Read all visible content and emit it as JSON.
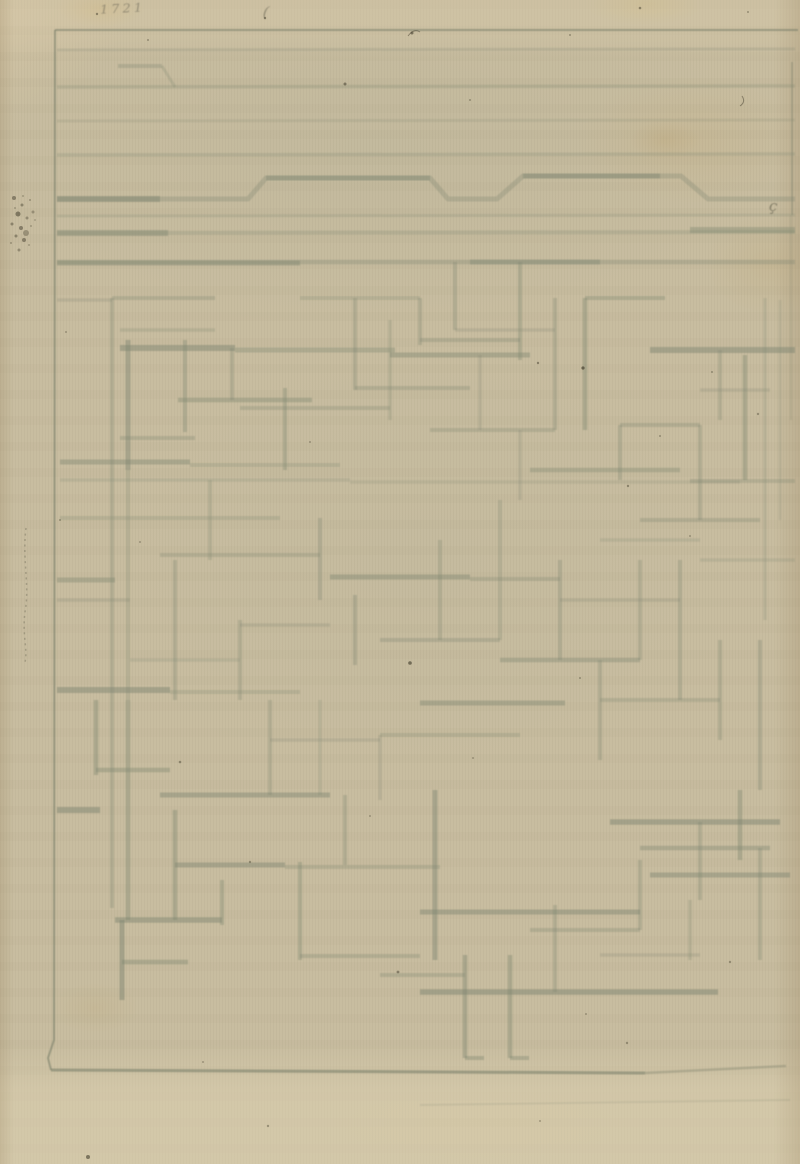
{
  "page": {
    "width": 800,
    "height": 1164
  },
  "colors": {
    "paper": "#c8bda0",
    "ink": "#7f8671",
    "frame_ink": "#6e7561",
    "speck": "#45402f",
    "inscription_ink": "#5f5c4a"
  },
  "inscriptions": {
    "corner_number": "1721",
    "paren_mark": "(",
    "cedilla_mark": "ç"
  },
  "drawing": {
    "frame": {
      "top": [
        55,
        30,
        798,
        30,
        2,
        0.5
      ],
      "left_points": "55,30 54,1040 48,1058 51,1070",
      "left_style": [
        2,
        0.5
      ],
      "bottom": [
        [
          51,
          1070,
          645,
          1073,
          3,
          0.5
        ],
        [
          645,
          1073,
          786,
          1066,
          2.5,
          0.3
        ],
        [
          420,
          1105,
          790,
          1100,
          2,
          0.12
        ]
      ],
      "right": [
        [
          792,
          62,
          792,
          215,
          2,
          0.3
        ],
        [
          791,
          215,
          791,
          420,
          2,
          0.15
        ]
      ]
    },
    "top_bands": [
      [
        57,
        50,
        795,
        49,
        3,
        0.22
      ],
      [
        57,
        87,
        795,
        86,
        3.5,
        0.26
      ],
      [
        57,
        121,
        795,
        120,
        3,
        0.18
      ],
      [
        57,
        155,
        795,
        154,
        3.5,
        0.24
      ],
      [
        57,
        216,
        795,
        215,
        3,
        0.2
      ],
      [
        57,
        233,
        795,
        232,
        4,
        0.26
      ],
      [
        57,
        233,
        168,
        233,
        6,
        0.42
      ],
      [
        690,
        230,
        795,
        230,
        6,
        0.4
      ],
      [
        57,
        262,
        795,
        262,
        4.5,
        0.3
      ],
      [
        57,
        263,
        300,
        263,
        5,
        0.42
      ],
      [
        470,
        262,
        600,
        262,
        5,
        0.38
      ],
      [
        57,
        199,
        160,
        199,
        6,
        0.45
      ],
      [
        266,
        178,
        430,
        178,
        5,
        0.35
      ],
      [
        523,
        176,
        660,
        176,
        5,
        0.4
      ],
      [
        118,
        66,
        162,
        66,
        4,
        0.3
      ],
      [
        162,
        66,
        175,
        87,
        3,
        0.25
      ]
    ],
    "band_bump_points": "57,199 248,199 266,178 430,178 448,199 497,199 523,176 681,176 708,199 795,199",
    "band_bump_style": [
      5,
      0.3
    ],
    "maze_segments": [
      [
        112,
        298,
        112,
        908,
        4,
        0.3
      ],
      [
        128,
        340,
        128,
        470,
        5,
        0.45
      ],
      [
        128,
        470,
        128,
        700,
        4,
        0.25
      ],
      [
        128,
        700,
        128,
        920,
        4.5,
        0.4
      ],
      [
        112,
        298,
        215,
        298,
        4,
        0.3
      ],
      [
        57,
        300,
        112,
        300,
        3.5,
        0.22
      ],
      [
        120,
        330,
        215,
        330,
        3.5,
        0.25
      ],
      [
        120,
        348,
        235,
        348,
        6,
        0.5
      ],
      [
        235,
        350,
        395,
        350,
        5,
        0.35
      ],
      [
        185,
        340,
        185,
        432,
        4,
        0.35
      ],
      [
        178,
        400,
        312,
        400,
        4.5,
        0.4
      ],
      [
        232,
        348,
        232,
        400,
        4,
        0.3
      ],
      [
        120,
        438,
        195,
        438,
        4,
        0.3
      ],
      [
        285,
        388,
        285,
        470,
        4,
        0.35
      ],
      [
        240,
        408,
        390,
        408,
        4,
        0.28
      ],
      [
        60,
        462,
        190,
        462,
        5,
        0.42
      ],
      [
        190,
        465,
        340,
        465,
        4,
        0.25
      ],
      [
        355,
        298,
        355,
        390,
        4,
        0.3
      ],
      [
        300,
        298,
        420,
        298,
        4,
        0.25
      ],
      [
        390,
        320,
        390,
        420,
        3.5,
        0.25
      ],
      [
        355,
        388,
        470,
        388,
        4,
        0.3
      ],
      [
        420,
        298,
        420,
        345,
        4,
        0.3
      ],
      [
        455,
        262,
        455,
        330,
        4,
        0.3
      ],
      [
        520,
        262,
        520,
        360,
        4,
        0.35
      ],
      [
        555,
        298,
        555,
        430,
        4,
        0.3
      ],
      [
        420,
        340,
        520,
        340,
        4,
        0.3
      ],
      [
        390,
        355,
        530,
        355,
        5,
        0.42
      ],
      [
        585,
        298,
        585,
        430,
        4.5,
        0.4
      ],
      [
        585,
        298,
        665,
        298,
        4,
        0.35
      ],
      [
        650,
        350,
        795,
        350,
        6,
        0.5
      ],
      [
        745,
        355,
        745,
        480,
        4.5,
        0.4
      ],
      [
        765,
        298,
        765,
        620,
        3.5,
        0.2
      ],
      [
        620,
        425,
        700,
        425,
        4,
        0.3
      ],
      [
        620,
        425,
        620,
        480,
        4,
        0.3
      ],
      [
        530,
        470,
        680,
        470,
        4.5,
        0.35
      ],
      [
        700,
        425,
        700,
        520,
        4,
        0.3
      ],
      [
        640,
        520,
        760,
        520,
        4,
        0.3
      ],
      [
        455,
        330,
        555,
        330,
        3.5,
        0.22
      ],
      [
        480,
        355,
        480,
        430,
        3.5,
        0.22
      ],
      [
        430,
        430,
        555,
        430,
        4,
        0.28
      ],
      [
        520,
        430,
        520,
        500,
        3.5,
        0.22
      ],
      [
        720,
        350,
        720,
        420,
        4,
        0.28
      ],
      [
        700,
        390,
        770,
        390,
        3.5,
        0.22
      ],
      [
        690,
        481,
        795,
        481,
        4,
        0.28
      ],
      [
        780,
        300,
        780,
        520,
        3,
        0.15
      ],
      [
        60,
        480,
        350,
        480,
        3.5,
        0.2
      ],
      [
        350,
        482,
        740,
        482,
        3.5,
        0.18
      ],
      [
        60,
        518,
        280,
        518,
        4,
        0.25
      ],
      [
        210,
        480,
        210,
        560,
        4,
        0.25
      ],
      [
        160,
        555,
        320,
        555,
        4,
        0.28
      ],
      [
        320,
        518,
        320,
        600,
        4,
        0.3
      ],
      [
        330,
        577,
        470,
        577,
        5,
        0.42
      ],
      [
        470,
        579,
        560,
        579,
        4,
        0.28
      ],
      [
        355,
        595,
        355,
        665,
        4,
        0.33
      ],
      [
        440,
        540,
        440,
        640,
        4,
        0.28
      ],
      [
        380,
        640,
        500,
        640,
        4,
        0.3
      ],
      [
        500,
        500,
        500,
        640,
        4,
        0.25
      ],
      [
        500,
        660,
        640,
        660,
        4.5,
        0.38
      ],
      [
        560,
        560,
        560,
        660,
        4,
        0.3
      ],
      [
        560,
        600,
        680,
        600,
        3.5,
        0.22
      ],
      [
        640,
        560,
        640,
        660,
        4,
        0.28
      ],
      [
        680,
        560,
        680,
        700,
        4,
        0.3
      ],
      [
        700,
        560,
        795,
        560,
        3.5,
        0.2
      ],
      [
        600,
        540,
        700,
        540,
        3.5,
        0.2
      ],
      [
        57,
        580,
        115,
        580,
        5,
        0.4
      ],
      [
        57,
        600,
        130,
        600,
        3.5,
        0.22
      ],
      [
        175,
        560,
        175,
        700,
        4,
        0.3
      ],
      [
        57,
        690,
        170,
        690,
        6,
        0.5
      ],
      [
        170,
        692,
        300,
        692,
        4,
        0.25
      ],
      [
        240,
        620,
        240,
        700,
        4,
        0.28
      ],
      [
        240,
        625,
        330,
        625,
        3.5,
        0.22
      ],
      [
        130,
        660,
        240,
        660,
        3.5,
        0.2
      ],
      [
        420,
        703,
        565,
        703,
        5,
        0.42
      ],
      [
        600,
        660,
        600,
        760,
        4,
        0.3
      ],
      [
        600,
        700,
        720,
        700,
        4,
        0.28
      ],
      [
        720,
        640,
        720,
        740,
        4,
        0.3
      ],
      [
        760,
        640,
        760,
        790,
        4,
        0.33
      ],
      [
        96,
        700,
        96,
        775,
        4.5,
        0.4
      ],
      [
        96,
        770,
        170,
        770,
        4.5,
        0.4
      ],
      [
        57,
        810,
        100,
        810,
        6,
        0.5
      ],
      [
        160,
        795,
        330,
        795,
        5,
        0.45
      ],
      [
        175,
        810,
        175,
        920,
        4.5,
        0.4
      ],
      [
        175,
        865,
        285,
        865,
        5,
        0.45
      ],
      [
        285,
        867,
        440,
        867,
        4,
        0.28
      ],
      [
        222,
        880,
        222,
        925,
        4,
        0.35
      ],
      [
        115,
        920,
        222,
        920,
        5.5,
        0.48
      ],
      [
        122,
        920,
        122,
        1000,
        5,
        0.5
      ],
      [
        122,
        962,
        188,
        962,
        4.5,
        0.4
      ],
      [
        300,
        862,
        300,
        960,
        4,
        0.35
      ],
      [
        300,
        956,
        420,
        956,
        4,
        0.3
      ],
      [
        345,
        795,
        345,
        865,
        4,
        0.3
      ],
      [
        435,
        790,
        435,
        960,
        5,
        0.45
      ],
      [
        380,
        735,
        520,
        735,
        4,
        0.25
      ],
      [
        380,
        735,
        380,
        800,
        3.5,
        0.22
      ],
      [
        270,
        700,
        270,
        795,
        4,
        0.28
      ],
      [
        270,
        740,
        380,
        740,
        3.5,
        0.22
      ],
      [
        320,
        700,
        320,
        795,
        3.5,
        0.2
      ],
      [
        380,
        975,
        465,
        975,
        4,
        0.3
      ],
      [
        420,
        992,
        718,
        992,
        5.5,
        0.5
      ],
      [
        465,
        955,
        465,
        1058,
        4.5,
        0.42
      ],
      [
        465,
        1058,
        484,
        1058,
        4,
        0.4
      ],
      [
        510,
        955,
        510,
        1058,
        4.5,
        0.4
      ],
      [
        510,
        1058,
        529,
        1058,
        4,
        0.38
      ],
      [
        555,
        905,
        555,
        992,
        4,
        0.3
      ],
      [
        530,
        930,
        640,
        930,
        4,
        0.3
      ],
      [
        420,
        912,
        640,
        912,
        5,
        0.45
      ],
      [
        640,
        860,
        640,
        930,
        4,
        0.3
      ],
      [
        610,
        822,
        780,
        822,
        5.5,
        0.5
      ],
      [
        640,
        848,
        770,
        848,
        4.5,
        0.38
      ],
      [
        700,
        822,
        700,
        900,
        4,
        0.3
      ],
      [
        740,
        790,
        740,
        860,
        4.5,
        0.4
      ],
      [
        650,
        875,
        790,
        875,
        5,
        0.45
      ],
      [
        760,
        848,
        760,
        960,
        4,
        0.3
      ],
      [
        600,
        955,
        700,
        955,
        3.5,
        0.22
      ],
      [
        690,
        900,
        690,
        960,
        3.5,
        0.25
      ]
    ],
    "squiggle_path": "M26,528 C22,560 30,585 25,612 C22,635 28,650 25,662",
    "hairs": [
      "M408,36 q6,-8 12,-4",
      "M742,96 q4,6 -2,10"
    ],
    "blotch_dots": [
      [
        14,
        198,
        2,
        0.5
      ],
      [
        22,
        205,
        1.5,
        0.45
      ],
      [
        30,
        200,
        1,
        0.35
      ],
      [
        18,
        214,
        2.5,
        0.55
      ],
      [
        27,
        218,
        1.5,
        0.4
      ],
      [
        12,
        224,
        1.5,
        0.45
      ],
      [
        21,
        228,
        2,
        0.5
      ],
      [
        31,
        226,
        1,
        0.3
      ],
      [
        16,
        236,
        1.5,
        0.45
      ],
      [
        24,
        240,
        2,
        0.5
      ],
      [
        29,
        245,
        1,
        0.3
      ],
      [
        11,
        243,
        1,
        0.35
      ],
      [
        19,
        250,
        1.5,
        0.4
      ],
      [
        26,
        233,
        3,
        0.35
      ],
      [
        15,
        208,
        1,
        0.3
      ],
      [
        33,
        212,
        1.5,
        0.35
      ],
      [
        23,
        196,
        1,
        0.3
      ],
      [
        35,
        220,
        1,
        0.25
      ]
    ],
    "specks": [
      [
        97,
        14,
        1.2,
        0.5
      ],
      [
        148,
        40,
        1,
        0.4
      ],
      [
        265,
        18,
        1.2,
        0.5
      ],
      [
        412,
        33,
        1.5,
        0.6
      ],
      [
        470,
        100,
        1,
        0.4
      ],
      [
        570,
        35,
        1,
        0.4
      ],
      [
        640,
        8,
        1.3,
        0.5
      ],
      [
        748,
        12,
        1,
        0.4
      ],
      [
        345,
        84,
        1.5,
        0.55
      ],
      [
        583,
        368,
        1.6,
        0.7
      ],
      [
        538,
        363,
        1.2,
        0.5
      ],
      [
        628,
        486,
        1.2,
        0.45
      ],
      [
        660,
        436,
        1,
        0.4
      ],
      [
        66,
        332,
        1,
        0.35
      ],
      [
        310,
        442,
        1,
        0.35
      ],
      [
        140,
        542,
        1,
        0.35
      ],
      [
        60,
        520,
        1,
        0.4
      ],
      [
        410,
        663,
        1.8,
        0.65
      ],
      [
        580,
        678,
        1,
        0.4
      ],
      [
        712,
        372,
        1,
        0.4
      ],
      [
        758,
        414,
        1.2,
        0.4
      ],
      [
        690,
        536,
        1,
        0.35
      ],
      [
        180,
        762,
        1.3,
        0.45
      ],
      [
        370,
        816,
        1,
        0.35
      ],
      [
        473,
        758,
        1,
        0.35
      ],
      [
        250,
        862,
        1.2,
        0.4
      ],
      [
        730,
        962,
        1.2,
        0.4
      ],
      [
        398,
        972,
        1.4,
        0.5
      ],
      [
        586,
        1014,
        1,
        0.35
      ],
      [
        627,
        1043,
        1.2,
        0.4
      ],
      [
        203,
        1062,
        1,
        0.35
      ],
      [
        88,
        1157,
        2,
        0.6
      ],
      [
        268,
        1126,
        1.2,
        0.4
      ],
      [
        540,
        1121,
        1,
        0.35
      ]
    ]
  }
}
